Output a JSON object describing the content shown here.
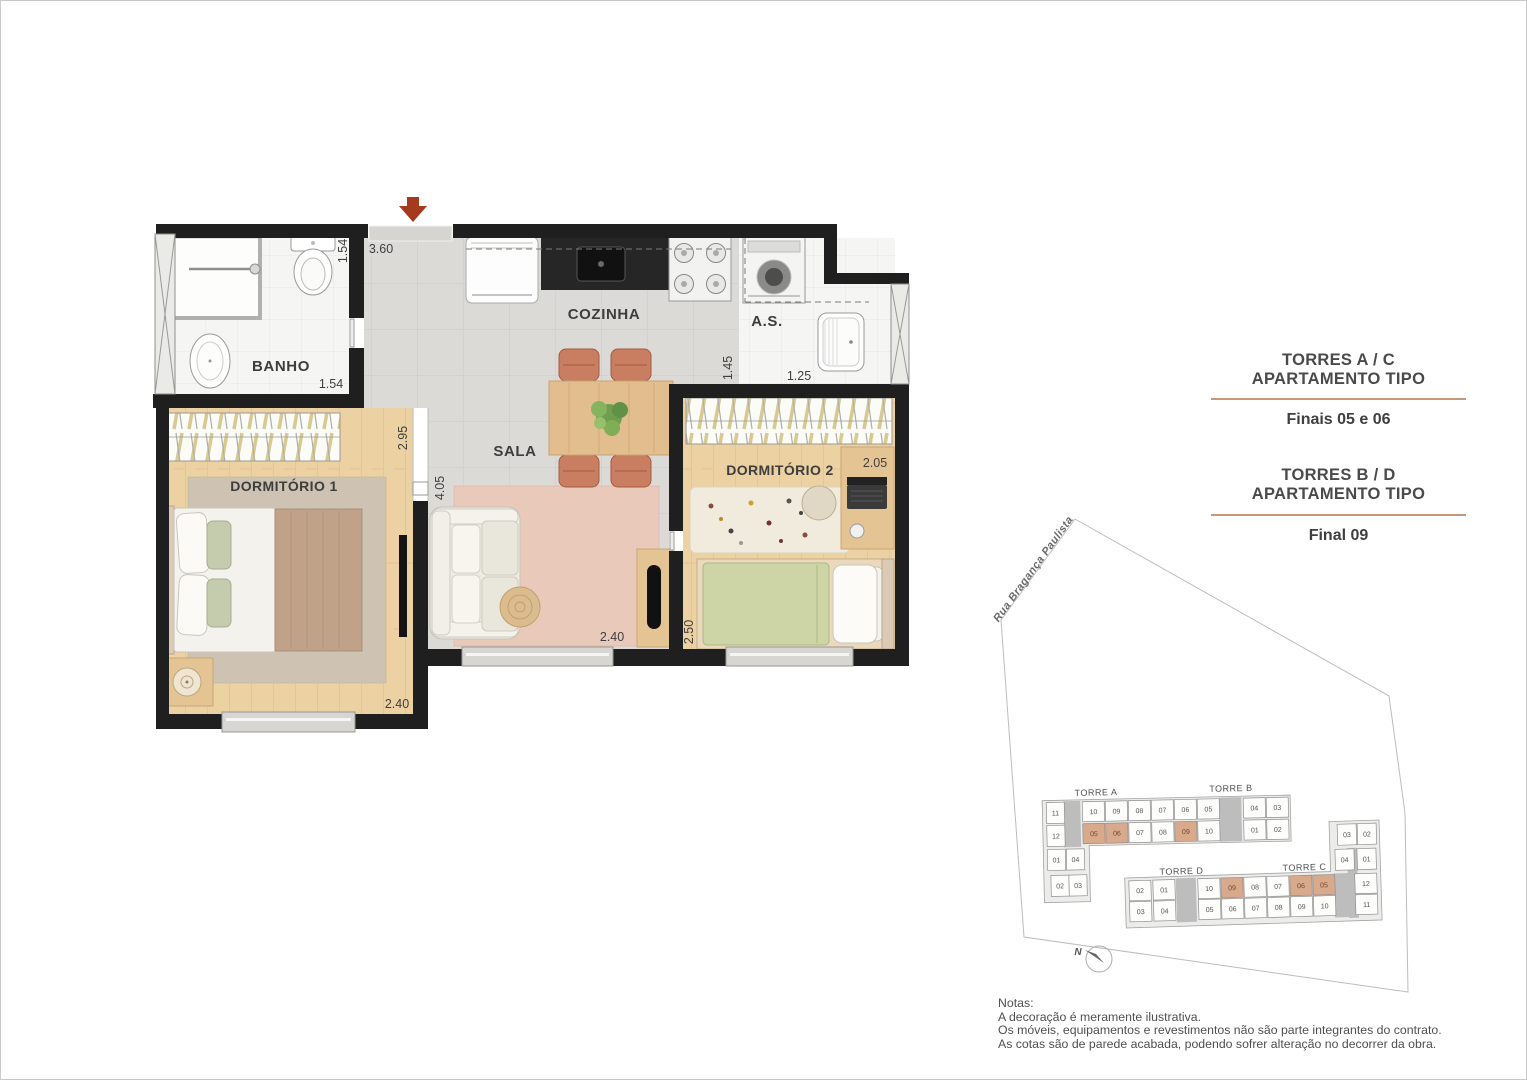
{
  "colors": {
    "wall": "#1f1f1f",
    "entrance_arrow": "#a43a1e",
    "panel_underline": "#c49878",
    "unit_highlight": "#d9a98c",
    "unit_fill": "#fdfdfc"
  },
  "floorplan": {
    "rooms": {
      "banho": "BANHO",
      "cozinha": "COZINHA",
      "servico": "A.S.",
      "sala": "SALA",
      "dorm1": "DORMITÓRIO 1",
      "dorm2": "DORMITÓRIO 2"
    },
    "dims": {
      "banho_v": "1.54",
      "banho_h": "1.54",
      "entry": "3.60",
      "dorm1_v": "2.95",
      "sala_v": "4.05",
      "servico_v": "1.45",
      "servico_h": "1.25",
      "dorm2_h": "2.05",
      "dorm1_w": "2.40",
      "sala_w": "2.40",
      "dorm2_v": "2.50"
    }
  },
  "panel": {
    "blocks": [
      {
        "title1": "TORRES A / C",
        "title2": "APARTAMENTO TIPO",
        "subtitle": "Finais 05 e 06"
      },
      {
        "title1": "TORRES B / D",
        "title2": "APARTAMENTO TIPO",
        "subtitle": "Final 09"
      }
    ]
  },
  "siteplan": {
    "street": "Rua Bragança Paulista",
    "north_label": "N",
    "buildings": {
      "ab": {
        "label_a": "TORRE A",
        "label_b": "TORRE B",
        "top": [
          "10",
          "09",
          "08",
          "07",
          "06",
          "05",
          "04",
          "03"
        ],
        "bottom": [
          "05",
          "06",
          "07",
          "08",
          "09",
          "10",
          "01",
          "02"
        ],
        "bottom_highlight": [
          0,
          1,
          4
        ],
        "wing": [
          "11",
          "12",
          "01",
          "04",
          "02",
          "03"
        ]
      },
      "dc": {
        "label_d": "TORRE D",
        "label_c": "TORRE C",
        "top": [
          "02",
          "01",
          "10",
          "09",
          "08",
          "07",
          "06",
          "05",
          "12"
        ],
        "top_highlight": [
          3,
          6,
          7
        ],
        "bottom": [
          "03",
          "04",
          "05",
          "06",
          "07",
          "08",
          "09",
          "10",
          "11"
        ],
        "wing": [
          "03",
          "02",
          "04",
          "01"
        ]
      }
    }
  },
  "notes": {
    "heading": "Notas:",
    "lines": [
      "A decoração é meramente ilustrativa.",
      "Os móveis, equipamentos e revestimentos não são parte integrantes do contrato.",
      "As cotas são de parede acabada, podendo sofrer alteração no decorrer da obra."
    ]
  }
}
